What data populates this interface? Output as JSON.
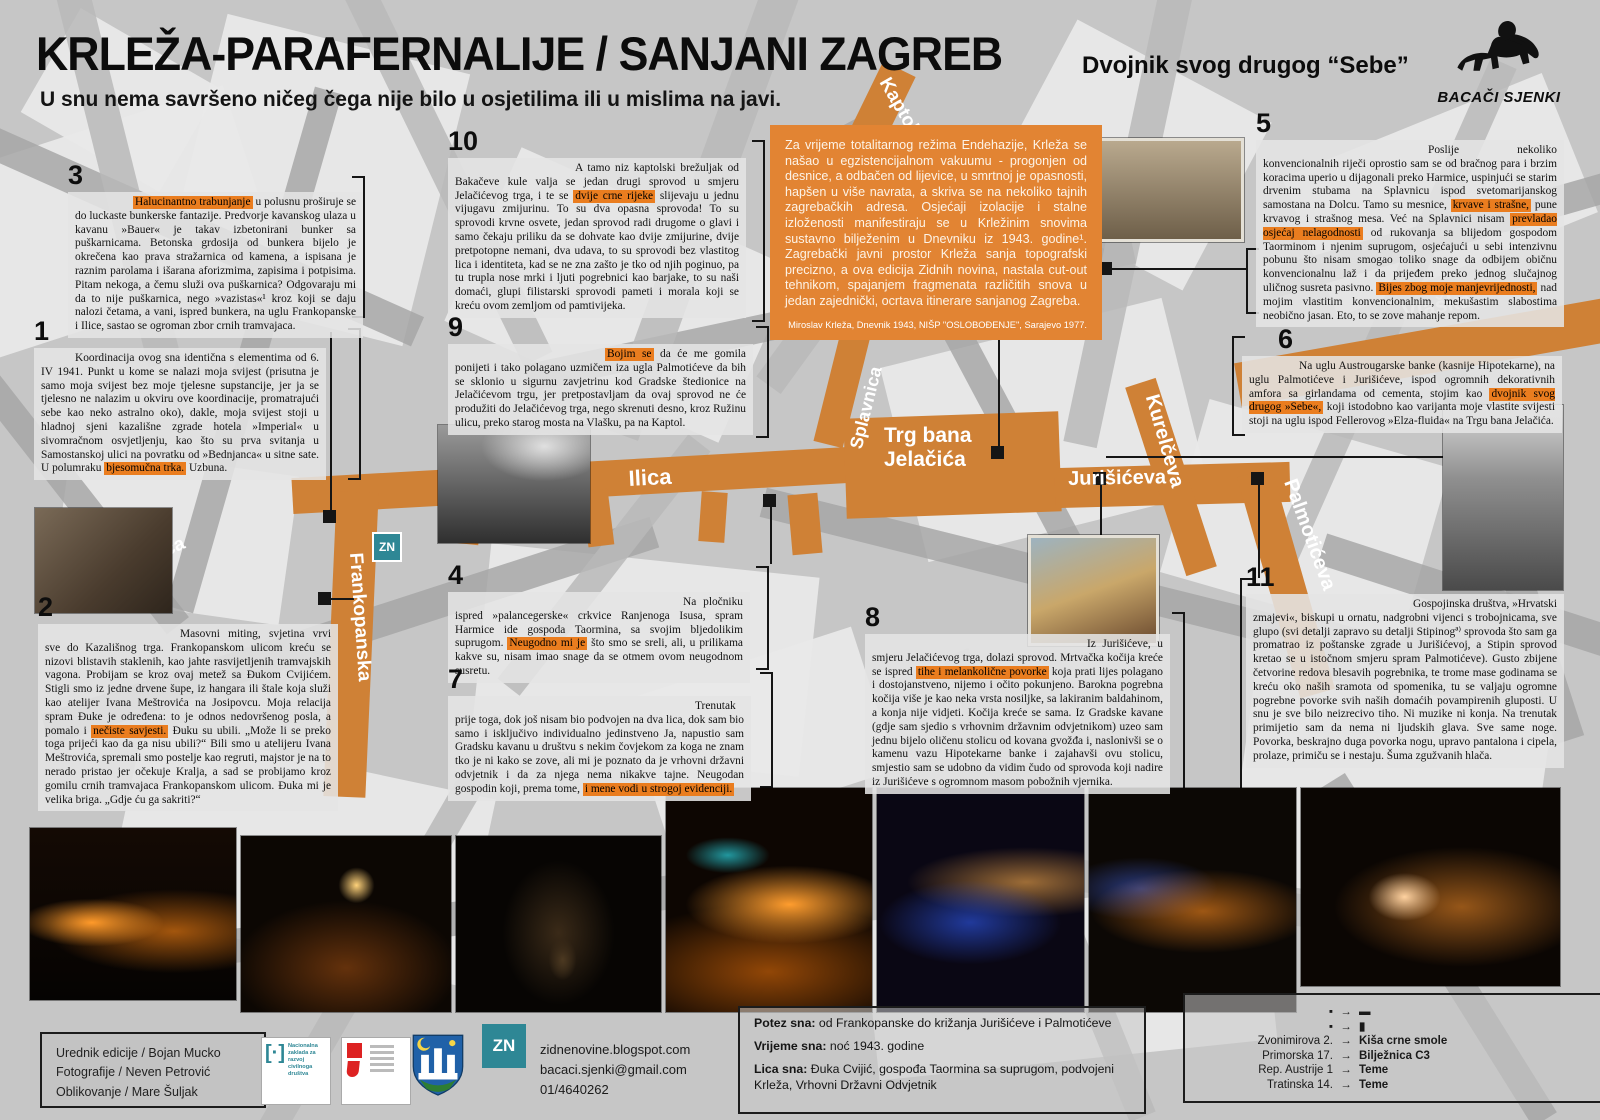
{
  "colors": {
    "route_orange": "#cf8136",
    "intro_orange": "#e28433",
    "highlight": "#ea7d1f",
    "teal": "#2e8795"
  },
  "header": {
    "title": "KRLEŽA-PARAFERNALIJE / SANJANI ZAGREB",
    "subtitle_right": "Dvojnik svog drugog “Sebe”",
    "tagline": "U snu nema savršeno ničeg čega nije bilo u osjetilima ili u mislima na javi.",
    "logo_text": "BACAČI SJENKI"
  },
  "intro": {
    "text": "Za vrijeme totalitarnog režima Endehazije, Krleža se našao u egzistencijalnom vakuumu - progonjen od desnice, a odbačen od lijevice, u smrtnoj je opasnosti, hapšen u više navrata, a skriva se na nekoliko tajnih zagrebačkih adresa. Osjećaji izolacije i stalne izloženosti manifestiraju se u Krležinim snovima sustavno bilježenim u Dnevniku iz 1943. godine¹. Zagrebački javni prostor Krleža sanja topografski precizno, a ova edicija Zidnih novina, nastala cut-out tehnikom, spajanjem fragmenata različitih snova u jedan zajednički, ocrtava itinerare sanjanog Zagreba.",
    "footnote": "Miroslav Krleža, Dnevnik 1943, NIŠP \"OSLOBOĐENJE\", Sarajevo 1977."
  },
  "blocks": [
    {
      "num": "3",
      "segments": [
        {
          "t": "Halucinantno trabunjanje",
          "hl": true
        },
        {
          "t": " u polusnu proširuje se do luckaste bunkerske fantazije. Predvorje kavanskog ulaza u kavanu »Bauer« je takav izbetonirani bunker sa puškarnicama. Betonska grdosija od bunkera bijelo je okrečena kao prava stražarnica od kamena, a ispisana je raznim parolama i išarana aforizmima, zapisima i potpisima. Pitam nekoga, a čemu služi ova puškarnica? Odgovaraju mi da to nije puškarnica, nego »vazistas«¹ kroz koji se daju nalozi četama, a vani, ispred bunkera, na uglu Frankopanske i Ilice, sastao se ogroman zbor crnih tramvajaca."
        }
      ]
    },
    {
      "num": "1",
      "segments": [
        {
          "t": "Koordinacija ovog sna identična s elementima od 6. IV 1941. Punkt u kome se nalazi moja svijest (prisutna je samo moja svijest bez moje tjelesne supstancije, jer ja se tjelesno ne nalazim u okviru ove koordinacije, promatrajući sebe kao neko astralno oko), dakle, moja svijest stoji u hladnoj sjeni kazališne zgrade hotela »Imperial« u sivomračnom osvjetljenju, kao što su prva svitanja u Samostanskoj ulici na povratku od »Bednjanca« u sitne sate. U polumraku "
        },
        {
          "t": "bjesomučna trka.",
          "hl": true
        },
        {
          "t": " Uzbuna."
        }
      ]
    },
    {
      "num": "2",
      "segments": [
        {
          "t": "Masovni miting, svjetina vrvi sve do Kazališnog trga. Frankopanskom ulicom kreću se nizovi blistavih staklenih, kao jahte rasvijetljenih tramvajskih vagona. Probijam se kroz ovaj metež sa Đukom Cvijićem. Stigli smo iz jedne drvene šupe, iz hangara ili štale koja služi kao atelijer Ivana Meštrovića na Josipovcu. Moja relacija spram Đuke je određena: to je odnos nedovršenog posla, a pomalo i "
        },
        {
          "t": "nečiste savjesti.",
          "hl": true
        },
        {
          "t": " Đuku su ubili. „Može li se preko toga prijeći kao da ga nisu ubili?“ Bili smo u atelijeru Ivana Meštrovića, spremali smo postelje kao regruti, majstor je na to nerado pristao jer očekuje Kralja, a sad se probijamo kroz gomilu crnih tramvajaca Frankopanskom ulicom. Đuka mi je velika briga. „Gdje ću ga sakriti?“"
        }
      ]
    },
    {
      "num": "10",
      "segments": [
        {
          "t": "A tamo niz kaptolski brežuljak od Bakačeve kule valja se jedan drugi sprovod u smjeru Jelačićevog trga, i te se "
        },
        {
          "t": "dvije crne rijeke",
          "hl": true
        },
        {
          "t": " slijevaju u jednu vijugavu zmijurinu. To su dva opasna sprovoda! To su sprovodi krvne osvete, jedan sprovod radi drugome o glavi i samo čekaju priliku da se dohvate kao dvije zmijurine, dvije pretpotopne nemani, dva udava, to su sprovodi bez vlastitog lica i identiteta, kad se ne zna zašto je tko od njih poginuo, pa tu trupla nose mrki i ljuti pogrebnici kao barjake, to su naši domaći, glupi filistarski sprovodi pameti i morala koji se kreću ovom zemljom od pamtivijeka."
        }
      ]
    },
    {
      "num": "9",
      "segments": [
        {
          "t": "Bojim se",
          "hl": true
        },
        {
          "t": " da će me gomila ponijeti i tako polagano uzmičem iza ugla Palmotićeve da bih se sklonio u sigurnu zavjetrinu kod Gradske štedionice na Jelačićevom trgu, jer pretpostavljam da ovaj sprovod ne će produžiti do Jelačićevog trga, nego skrenuti desno, kroz Ružinu ulicu, preko starog mosta na Vlašku, pa na Kaptol."
        }
      ]
    },
    {
      "num": "4",
      "segments": [
        {
          "t": "Na pločniku ispred »palancegerske« crkvice Ranjenoga Isusa, spram Harmice ide gospoda Taormina, sa svojim bljedolikim suprugom. "
        },
        {
          "t": "Neugodno mi je",
          "hl": true
        },
        {
          "t": " što smo se sreli, ali, u prilikama kakve su, nisam imao snage da se otmem ovom neugodnom susretu."
        }
      ]
    },
    {
      "num": "7",
      "segments": [
        {
          "t": "Trenutak prije toga, dok još nisam bio podvojen na dva lica, dok sam bio samo i isključivo individualno jedinstveno Ja, napustio sam Gradsku kavanu u društvu s nekim čovjekom za koga ne znam tko je ni kako se zove, ali mi je poznato da je vrhovni državni odvjetnik i da za njega nema nikakve tajne. Neugodan gospodin koji, prema tome, "
        },
        {
          "t": "i mene vodi u strogoj evidenciji.",
          "hl": true
        }
      ]
    },
    {
      "num": "8",
      "segments": [
        {
          "t": "Iz Jurišićeve, u smjeru Jelačićevog trga, dolazi sprovod. Mrtvačka kočija kreće se ispred "
        },
        {
          "t": "tihe i melankolične povorke",
          "hl": true
        },
        {
          "t": " koja prati lijes polagano i dostojanstveno, nijemo i očito pokunjeno. Barokna pogrebna kočija više je kao neka vrsta nosiljke, sa lakiranim baldahinom, a konja nije vidjeti. Kočija kreće se sama. Iz Gradske kavane (gdje sam sjedio s vrhovnim državnim odvjetnikom) uzeo sam jednu bijelo oličenu stolicu od kovana gvožđa i, naslonivši se o kamenu vazu Hipotekarne banke i zajahavši ovu stolicu, smjestio sam se udobno da vidim čudo od sprovoda koji nadire iz Jurišićeve s ogromnom masom pobožnih vjernika."
        }
      ]
    },
    {
      "num": "5",
      "segments": [
        {
          "t": "Poslije nekoliko konvencionalnih riječi oprostio sam se od bračnog para i brzim koracima uperio u dijagonali preko Harmice, uspinjući se starim drvenim stubama na Splavnicu ispod svetomarijanskog samostana na Dolcu. Tamo su mesnice, "
        },
        {
          "t": "krvave i strašne,",
          "hl": true
        },
        {
          "t": " pune krvavog i strašnog mesa. Već na Splavnici nisam "
        },
        {
          "t": "prevladao osjećaj nelagodnosti",
          "hl": true
        },
        {
          "t": " od rukovanja sa blijedom gospodom Taorminom i njenim suprugom, osjećajući u sebi intenzivnu pobunu što nisam smogao toliko snage da odbijem običnu konvencionalnu laž i da prijeđem preko jednog slučajnog uličnog susreta pasivno. "
        },
        {
          "t": "Bijes zbog moje manjevrijednosti,",
          "hl": true
        },
        {
          "t": " nad mojim vlastitim konvencionalnim, mekušastim slabostima neobično jasan. Eto, to se zove mahanje repom."
        }
      ]
    },
    {
      "num": "6",
      "segments": [
        {
          "t": "Na uglu Austrougarske banke (kasnije Hipotekarne), na uglu Palmotićeve i Jurišićeve, ispod ogromnih dekorativnih amfora sa girlandama od cementa, stojim kao "
        },
        {
          "t": "dvojnik svog drugog »Sebe«,",
          "hl": true
        },
        {
          "t": " koji istodobno kao varijanta moje vlastite svijesti stoji na uglu ispod Fellerovog »Elza-fluida« na Trgu bana Jelačića."
        }
      ]
    },
    {
      "num": "11",
      "segments": [
        {
          "t": "Gospojinska društva, »Hrvatski zmajevi«, biskupi u ornatu, nadgrobni vijenci s trobojnicama, sve glupo (svi detalji zapravo su detalji Stipinogª⁾ sprovoda što sam ga promatrao iz poštanske zgrade u Jurišićevoj, a Stipin sprovod kretao se u istočnom smjeru spram Palmotićeve). Gusto zbijene četvorine redova blesavih pogrebnika, te trome mase godinama se kreću oko naših sramota od spomenika, tu se valjaju ogromne pogrebne povorke svih naših domaćih povampirenih gluposti. U snu je sve bilo neizrecivo tiho. Ni muzike ni konja. Na trenutak primijetio sam da nema ni ljudskih glava. Sve same noge. Povorka, beskrajno duga povorka nogu, upravo pantalona i cipela, prolaze, primiču se i nestaju. Šuma zgužvanih hlača."
        }
      ]
    }
  ],
  "map": {
    "marker": "ZN",
    "labels": {
      "ilica_left": "Ilica",
      "ilica": "Ilica",
      "frankopanska": "Frankopanska",
      "kaptol": "Kaptol",
      "splavnica": "Splavnica",
      "trg": "Trg bana\nJelačića",
      "jurisiceva": "Jurišićeva",
      "kurelceva": "Kurelčeva",
      "vlaska": "Vlaška",
      "palmoticeva": "Palmotićeva"
    }
  },
  "footer": {
    "credits": [
      "Urednik edicije / Bojan Mucko",
      "Fotografije / Neven Petrović",
      "Oblikovanje / Mare Šuljak"
    ],
    "contact": [
      "zidnenovine.blogspot.com",
      "bacaci.sjenki@gmail.com",
      "01/4640262"
    ],
    "dream": [
      {
        "label": "Potez sna:",
        "text": "od Frankopanske do križanja Jurišićeve i Palmotićeve"
      },
      {
        "label": "Vrijeme sna:",
        "text": "noć 1943. godine"
      },
      {
        "label": "Lica sna:",
        "text": "Đuka Cvijić, gospođa Taormina sa suprugom, podvojeni Krleža, Vrhovni Državni Odvjetnik"
      }
    ],
    "legend_arrow": "→",
    "legend": [
      {
        "left": "▪",
        "right": "▬"
      },
      {
        "left": "▪",
        "right": "▮"
      },
      {
        "left": "Zvonimirova 2.",
        "right": "Kiša crne smole"
      },
      {
        "left": "Primorska 17.",
        "right": "Bilježnica C3"
      },
      {
        "left": "Rep. Austrije 1",
        "right": "Teme"
      },
      {
        "left": "Tratinska 14.",
        "right": "Teme"
      }
    ],
    "logos": {
      "zn": "ZN",
      "nacionalna": "Nacionalna zaklada za razvoj civilnoga društva"
    }
  }
}
